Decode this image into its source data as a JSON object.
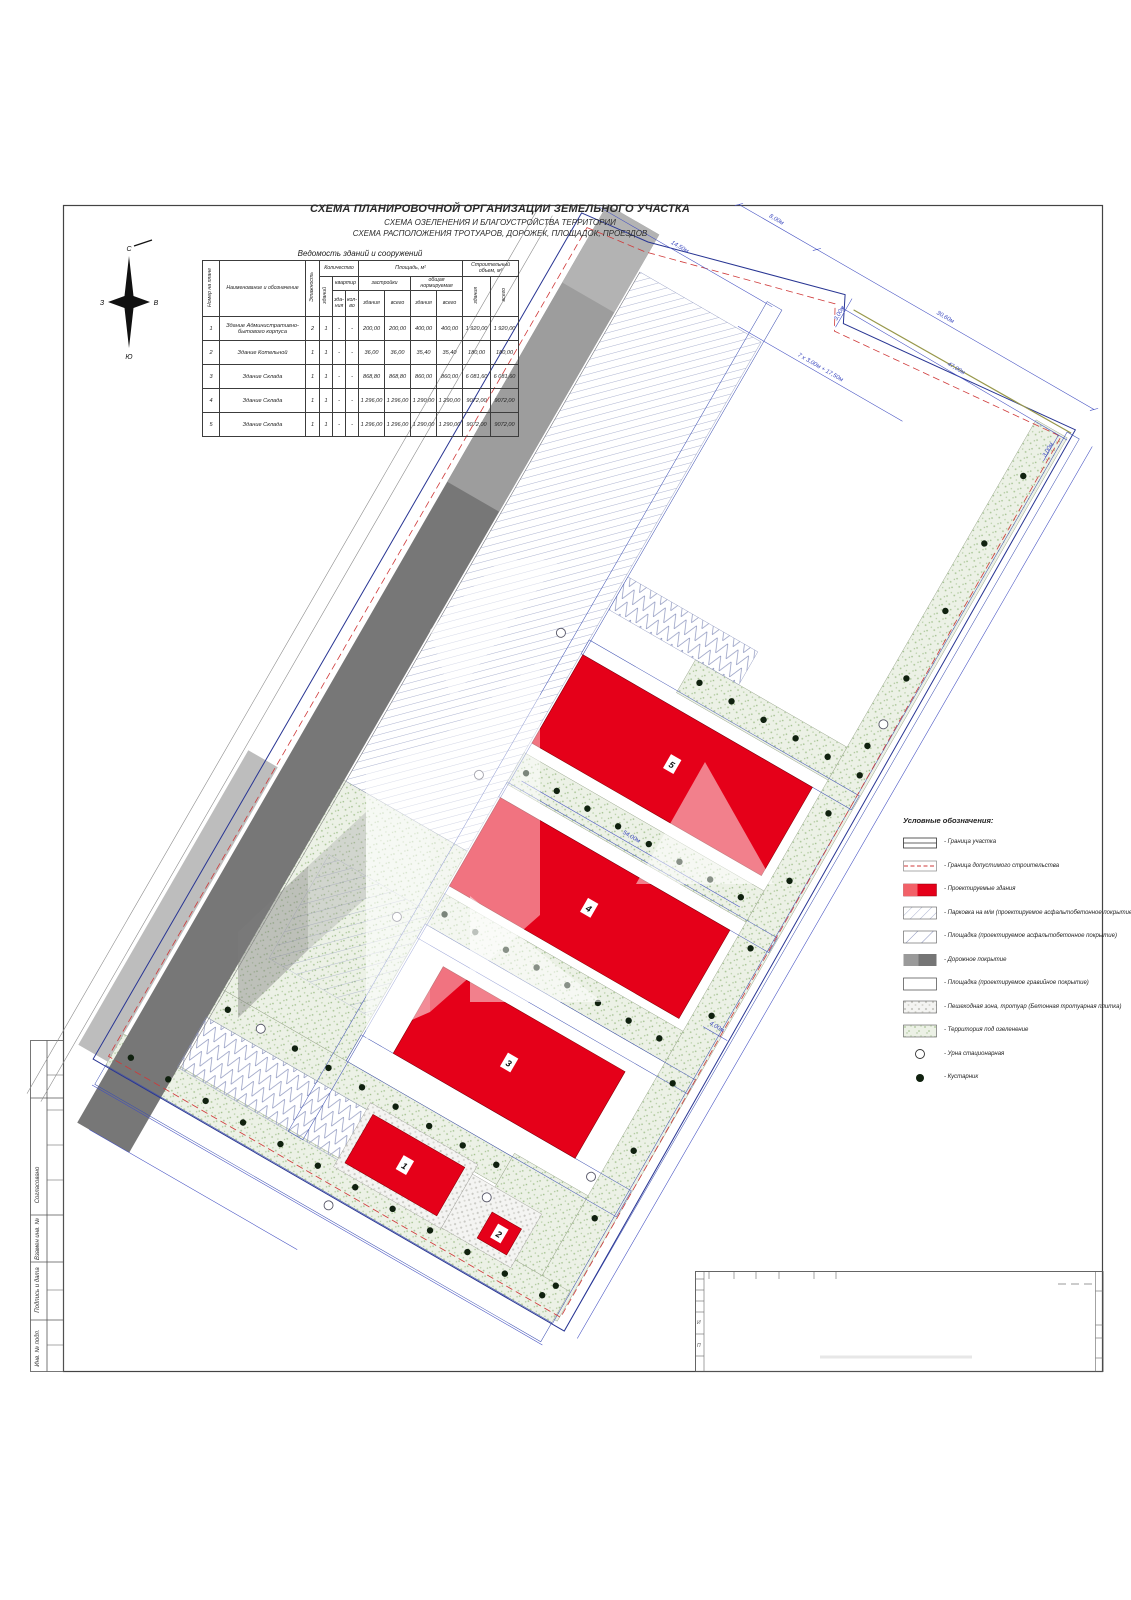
{
  "titles": {
    "line1": "СХЕМА ПЛАНИРОВОЧНОЙ ОРГАНИЗАЦИИ ЗЕМЕЛЬНОГО УЧАСТКА",
    "line2": "СХЕМА ОЗЕЛЕНЕНИЯ И БЛАГОУСТРОЙСТВА ТЕРРИТОРИИ",
    "line3": "СХЕМА РАСПОЛОЖЕНИЯ ТРОТУАРОВ, ДОРОЖЕК, ПЛОЩАДОК, ПРОЕЗДОВ"
  },
  "compass": {
    "n": "С",
    "s": "Ю",
    "w": "З",
    "e": "В"
  },
  "table": {
    "title": "Ведомость зданий и сооружений",
    "headers": {
      "num": "Номер на плане",
      "name": "Наименование и обозначение",
      "floors": "Этажность",
      "qty": "Количество",
      "qty_bld": "зданий",
      "qty_apt": "квартир",
      "qty_apt_bld": "зда-ния",
      "qty_apt_cnt": "кол-во",
      "area": "Площадь, м²",
      "area_built": "застройки",
      "area_norm": "общая нормируемая",
      "bld": "здания",
      "total": "всего",
      "volume": "Строительный объем, м³"
    },
    "rows": [
      [
        "1",
        "Здание Административно-бытового корпуса",
        "2",
        "1",
        "-",
        "-",
        "200,00",
        "200,00",
        "400,00",
        "400,00",
        "1 920,00",
        "1 920,00"
      ],
      [
        "2",
        "Здание Котельной",
        "1",
        "1",
        "-",
        "-",
        "36,00",
        "36,00",
        "35,40",
        "35,40",
        "180,00",
        "180,00"
      ],
      [
        "3",
        "Здание Склада",
        "1",
        "1",
        "-",
        "-",
        "868,80",
        "868,80",
        "860,00",
        "860,00",
        "6 081,60",
        "6 081,60"
      ],
      [
        "4",
        "Здание Склада",
        "1",
        "1",
        "-",
        "-",
        "1 296,00",
        "1 296,00",
        "1 290,00",
        "1 290,00",
        "9072,00",
        "9072,00"
      ],
      [
        "5",
        "Здание Склада",
        "1",
        "1",
        "-",
        "-",
        "1 296,00",
        "1 296,00",
        "1 290,00",
        "1 290,00",
        "9072,00",
        "9072,00"
      ]
    ]
  },
  "legend": {
    "title": "Условные обозначения:",
    "items": [
      "- Граница участка",
      "- Граница допустимого строительства",
      "- Проектируемые здания",
      "- Парковка на м/м  (проектируемое асфальтобетонное покрытие)",
      "- Площадка  (проектируемое асфальтобетонное покрытие)",
      "- Дорожное покрытие",
      "- Площадка  (проектируемое гравийное покрытие)",
      "- Пешеходная зона, тротуар  (Бетонная тротуарная плитка)",
      "- Территория под озеленение",
      "- Урна стационарная",
      "- Кустарник"
    ]
  },
  "margin": {
    "labels": [
      "Согласовано",
      "Взамен инв. №",
      "Подпись и дата",
      "Инв. № подл."
    ]
  },
  "stamp": {
    "letters": [
      "И",
      "П"
    ]
  },
  "plan": {
    "buildings": [
      {
        "n": "5",
        "cx": 282,
        "cy": 440
      },
      {
        "n": "4",
        "cx": 282,
        "cy": 606
      },
      {
        "n": "3",
        "cx": 290,
        "cy": 780
      },
      {
        "n": "1",
        "cx": 251,
        "cy": 921
      },
      {
        "n": "2",
        "cx": 367,
        "cy": 933
      }
    ],
    "dimensions": [
      {
        "t": "8,00м",
        "x": 100,
        "y": -82,
        "r": 0
      },
      {
        "t": "30,60м",
        "x": 295,
        "y": -82,
        "r": 0
      },
      {
        "t": "47,00м",
        "x": 330,
        "y": -43,
        "r": 0
      },
      {
        "t": "14,50м",
        "x": 30,
        "y": -10,
        "r": 0
      },
      {
        "t": "7 х 3,00м + 17,50м",
        "x": 212,
        "y": 24,
        "r": 0
      },
      {
        "t": "3,00м",
        "x": 203,
        "y": -34,
        "r": -90
      },
      {
        "t": "3,00м",
        "x": 452,
        "y": -20,
        "r": -90
      },
      {
        "t": "54,00м",
        "x": 283,
        "y": 525,
        "r": 0
      },
      {
        "t": "4,00м",
        "x": 452,
        "y": 647,
        "r": 0
      }
    ]
  },
  "colors": {
    "building_red": "#e50019",
    "road_gray": "#787878",
    "green_fill": "#ecf1e6",
    "boundary_blue": "#283593",
    "dimension_blue": "#3f4cc0",
    "setback_red": "#cf3a3a"
  }
}
